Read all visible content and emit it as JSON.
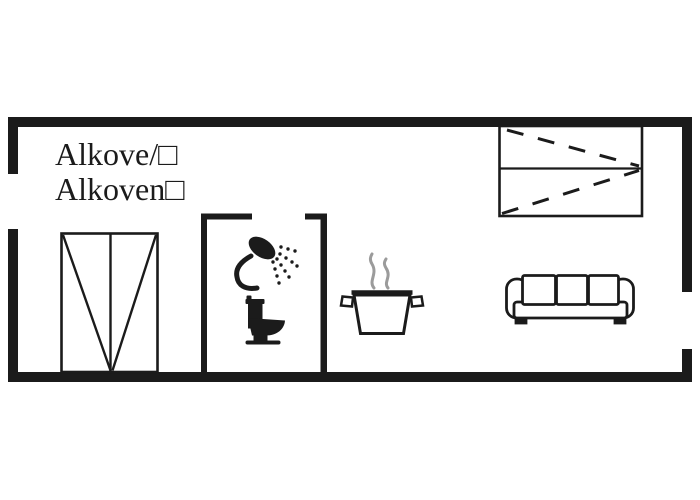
{
  "image_type": "floor-plan",
  "labels": {
    "line1": "Alkove/□",
    "line2": "Alkoven□"
  },
  "colors": {
    "background": "#ffffff",
    "wall": "#1b1b1b",
    "line": "#1b1b1b",
    "steam": "#9b9b9b",
    "text": "#1b1b1b"
  },
  "icons": [
    "wardrobe-icon",
    "shower-icon",
    "toilet-icon",
    "cooking-pot-icon",
    "steam-icon",
    "sofa-icon",
    "alcove-bed-icon"
  ]
}
